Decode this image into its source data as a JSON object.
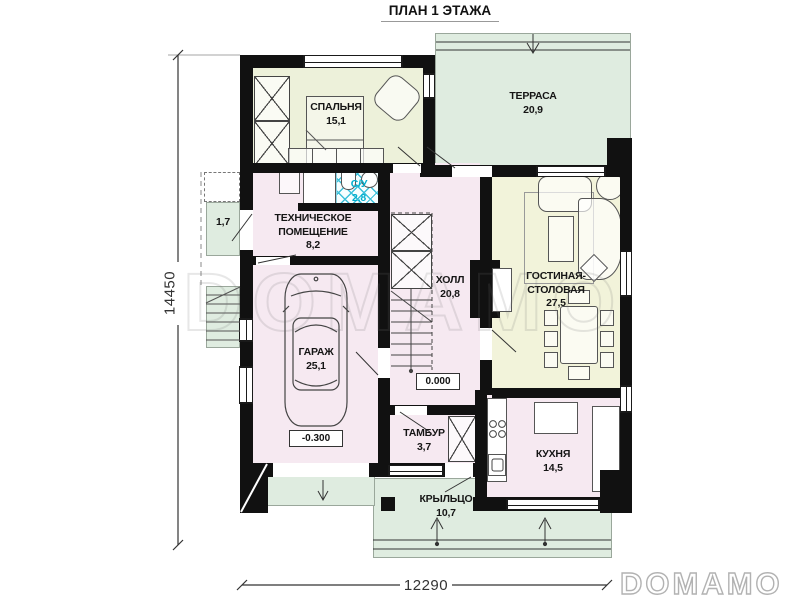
{
  "title": "ПЛАН 1 ЭТАЖА",
  "watermark": "DOMAMO",
  "brand": "DOMAMO",
  "dimensions": {
    "left_total": "14450",
    "bottom_total": "12290"
  },
  "levels": {
    "ground": "0.000",
    "garage": "-0.300"
  },
  "rooms": {
    "bedroom": {
      "name": "СПАЛЬНЯ",
      "area": "15,1"
    },
    "terrace": {
      "name": "ТЕРРАСА",
      "area": "20,9"
    },
    "technical": {
      "line1": "ТЕХНИЧЕСКОЕ",
      "line2": "ПОМЕЩЕНИЕ",
      "area": "8,2"
    },
    "bathroom": {
      "name": "С/У",
      "area": "2,8"
    },
    "hall": {
      "name": "ХОЛЛ",
      "area": "20,8"
    },
    "living": {
      "line1": "ГОСТИНАЯ-",
      "line2": "СТОЛОВАЯ",
      "area": "27,5"
    },
    "garage": {
      "name": "ГАРАЖ",
      "area": "25,1"
    },
    "vestibule": {
      "name": "ТАМБУР",
      "area": "3,7"
    },
    "kitchen": {
      "name": "КУХНЯ",
      "area": "14,5"
    },
    "porch": {
      "name": "КРЫЛЬЦО",
      "area": "10,7"
    },
    "side_entry": {
      "area": "1,7"
    }
  },
  "colors": {
    "wall": "#111111",
    "floor_pink": "#f6e9f1",
    "floor_green": "#dfece0",
    "floor_yellow": "#f2f3da",
    "floor_bedroom": "#edf1da",
    "tile_accent": "#3cc0da",
    "bath_text": "#00aecd"
  }
}
